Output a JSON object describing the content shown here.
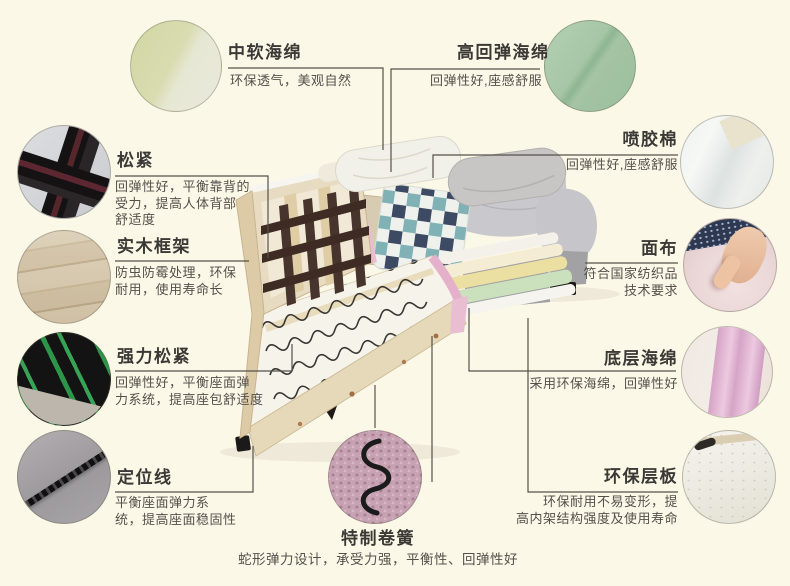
{
  "colors": {
    "background": "#fcf8e8",
    "leader_line": "#55514a",
    "title_text": "#3b3935",
    "desc_text": "#55504a",
    "pink_trim": "#ecbcd3",
    "webbing_green": "#2c9549",
    "foam_green": "#cbe0bc",
    "foam_yellow": "#ecdfa2"
  },
  "callouts": [
    {
      "id": "soft-foam",
      "title": "中软海绵",
      "lines": [
        "环保透气，美观自然"
      ]
    },
    {
      "id": "high-resilience-foam",
      "title": "高回弹海绵",
      "lines": [
        "回弹性好,座感舒服"
      ]
    },
    {
      "id": "elastic-webbing",
      "title": "松紧",
      "lines": [
        "回弹性好，平衡靠背的",
        "受力，提高人体背部",
        "舒适度"
      ]
    },
    {
      "id": "solid-wood-frame",
      "title": "实木框架",
      "lines": [
        "防虫防霉处理，环保",
        "耐用，使用寿命长"
      ]
    },
    {
      "id": "strong-webbing",
      "title": "强力松紧",
      "lines": [
        "回弹性好，平衡座面弹",
        "力系统，提高座包舒适度"
      ]
    },
    {
      "id": "positioning-line",
      "title": "定位线",
      "lines": [
        "平衡座面弹力系",
        "统，提高座面稳固性"
      ]
    },
    {
      "id": "spray-bonded-cotton",
      "title": "喷胶棉",
      "lines": [
        "回弹性好,座感舒服"
      ]
    },
    {
      "id": "cover-fabric",
      "title": "面布",
      "lines": [
        "符合国家纺织品",
        "技术要求"
      ]
    },
    {
      "id": "bottom-foam",
      "title": "底层海绵",
      "lines": [
        "采用环保海绵，回弹性好"
      ]
    },
    {
      "id": "eco-board",
      "title": "环保层板",
      "lines": [
        "环保耐用不易变形，提",
        "高内架结构强度及使用寿命"
      ]
    },
    {
      "id": "special-coil-spring",
      "title": "特制卷簧",
      "lines": [
        "蛇形弹力设计，承受力强，平衡性、回弹性好"
      ]
    }
  ]
}
